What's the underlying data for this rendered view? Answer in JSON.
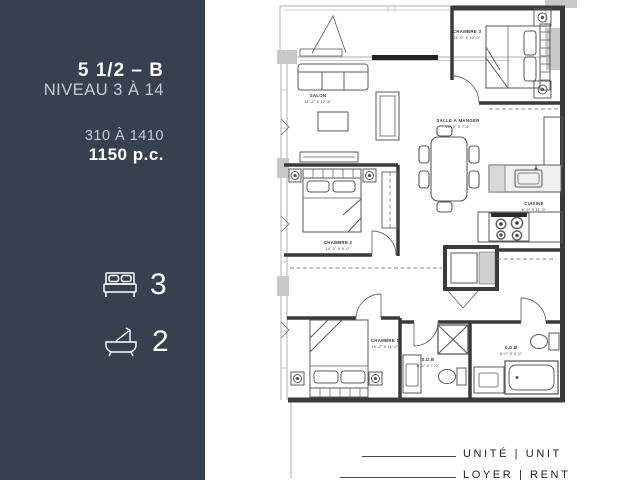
{
  "sidebar": {
    "title": "5 1/2 – B",
    "level": "NIVEAU 3 À 14",
    "units_range": "310 À 1410",
    "area": "1150 p.c.",
    "bedrooms": "3",
    "bathrooms": "2"
  },
  "plan": {
    "rooms": {
      "salon": {
        "name": "SALON",
        "dims": "11'-2\" X 12'-6\""
      },
      "chambre3": {
        "name": "CHAMBRE 3",
        "dims": "11'-0\" X 10'-0\""
      },
      "salle_a_manger": {
        "name": "SALLE À MANGER",
        "dims": "10'-0\" X 7'-6\""
      },
      "cuisine": {
        "name": "CUISINE",
        "dims": "8'-6\" X 11'-0\""
      },
      "chambre2": {
        "name": "CHAMBRE 2",
        "dims": "10'-0\" X 9'-0\""
      },
      "chambre1": {
        "name": "CHAMBRE 1",
        "dims": "10'-0\" X 11'-0\""
      },
      "sdb1": {
        "name": "S.D.B",
        "dims": "6'-2\" X 7'-0\""
      },
      "sdb2": {
        "name": "S.D.B",
        "dims": "8'-0\" X 5'-0\""
      }
    }
  },
  "footer": {
    "unit_label": "UNITÉ | UNIT",
    "rent_label": "LOYER | RENT"
  },
  "colors": {
    "sidebar_bg": "#37404E",
    "sidebar_text_light": "#C7CCD4",
    "sidebar_text_white": "#FFFFFF",
    "wall": "#3A3A3A",
    "light_wall": "#BDBDBD"
  }
}
